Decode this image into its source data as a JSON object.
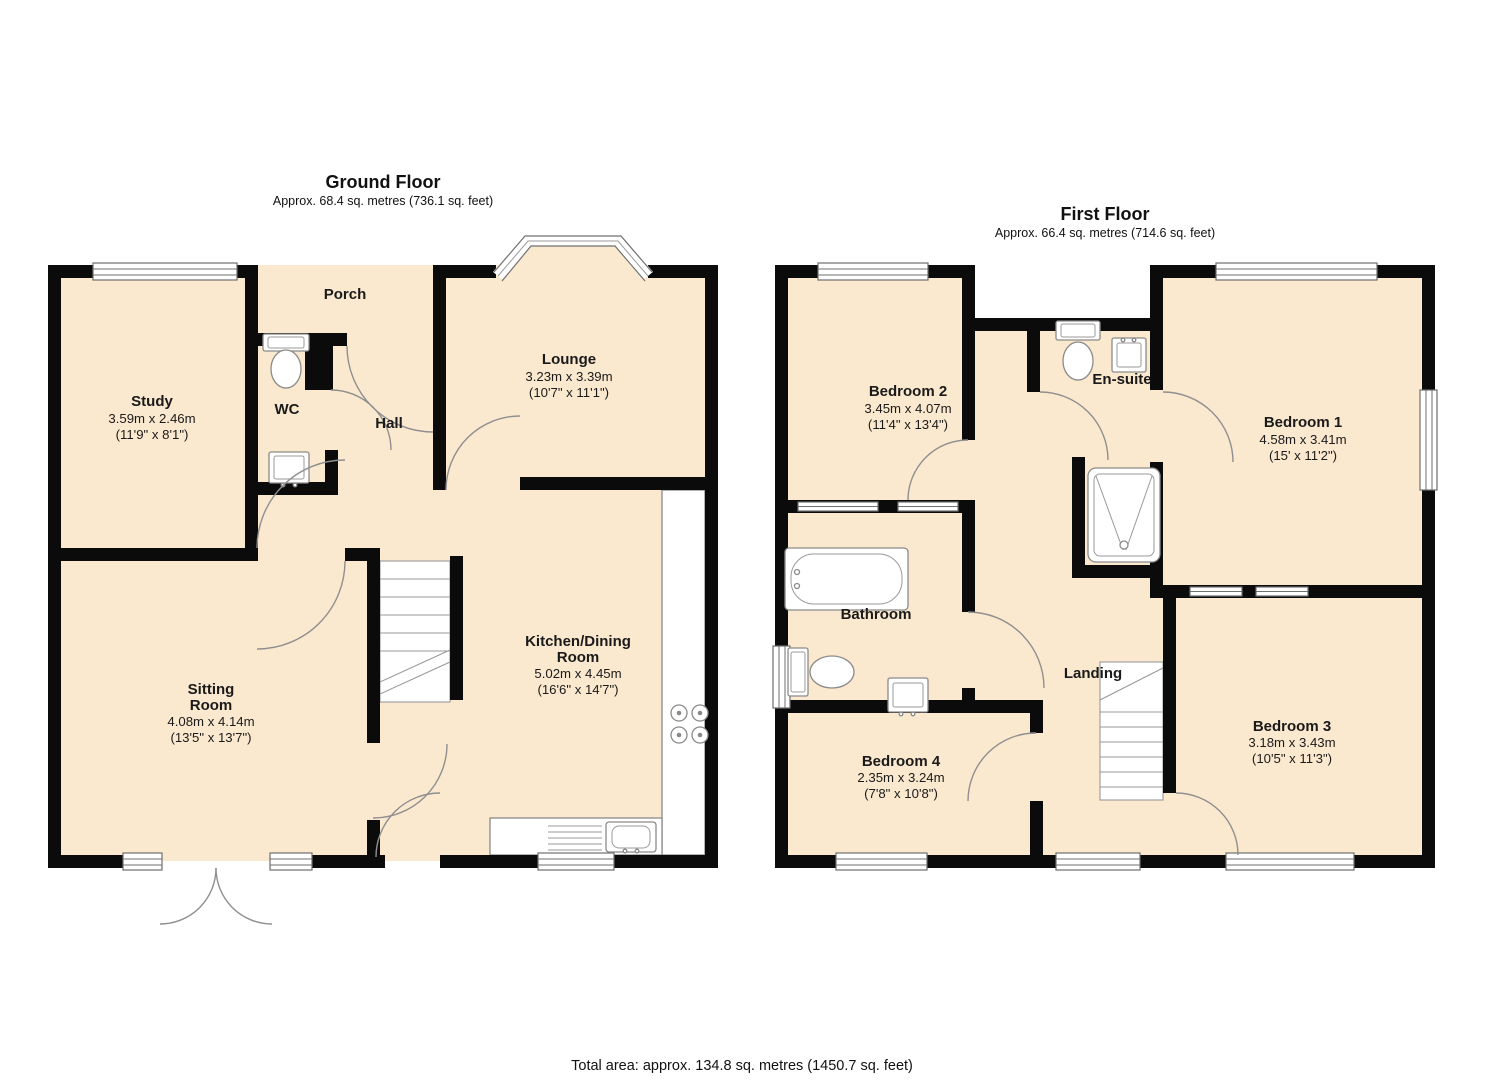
{
  "footer": {
    "total_area": "Total area: approx. 134.8 sq. metres (1450.7 sq. feet)"
  },
  "colors": {
    "room_fill": "#fbe9cf",
    "wall": "#0b0b0b",
    "fixture_stroke": "#8a8a8a"
  },
  "floors": {
    "ground": {
      "title": "Ground Floor",
      "subtitle": "Approx. 68.4 sq. metres (736.1 sq. feet)",
      "rooms": {
        "porch": {
          "name": "Porch"
        },
        "study": {
          "name": "Study",
          "metric": "3.59m x 2.46m",
          "imperial": "(11'9\" x 8'1\")"
        },
        "wc": {
          "name": "WC"
        },
        "hall": {
          "name": "Hall"
        },
        "lounge": {
          "name": "Lounge",
          "metric": "3.23m x 3.39m",
          "imperial": "(10'7\" x 11'1\")"
        },
        "sitting": {
          "name1": "Sitting",
          "name2": "Room",
          "metric": "4.08m x 4.14m",
          "imperial": "(13'5\" x 13'7\")"
        },
        "kitchen": {
          "name1": "Kitchen/Dining",
          "name2": "Room",
          "metric": "5.02m x 4.45m",
          "imperial": "(16'6\" x 14'7\")"
        }
      }
    },
    "first": {
      "title": "First Floor",
      "subtitle": "Approx. 66.4 sq. metres (714.6 sq. feet)",
      "rooms": {
        "bedroom2": {
          "name": "Bedroom 2",
          "metric": "3.45m x 4.07m",
          "imperial": "(11'4\" x 13'4\")"
        },
        "ensuite": {
          "name": "En-suite"
        },
        "bedroom1": {
          "name": "Bedroom 1",
          "metric": "4.58m x 3.41m",
          "imperial": "(15' x 11'2\")"
        },
        "bathroom": {
          "name": "Bathroom"
        },
        "landing": {
          "name": "Landing"
        },
        "bedroom4": {
          "name": "Bedroom 4",
          "metric": "2.35m x 3.24m",
          "imperial": "(7'8\" x 10'8\")"
        },
        "bedroom3": {
          "name": "Bedroom 3",
          "metric": "3.18m x 3.43m",
          "imperial": "(10'5\" x 11'3\")"
        }
      }
    }
  }
}
